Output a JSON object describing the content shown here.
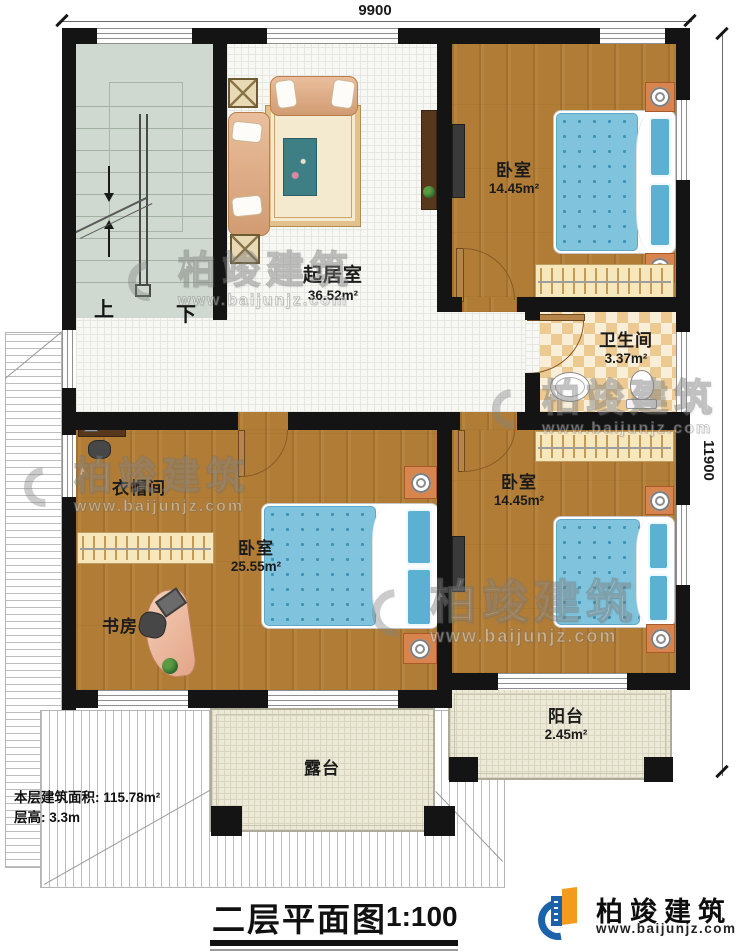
{
  "dimensions": {
    "width_label": "9900",
    "height_label": "11900"
  },
  "stairs": {
    "up_label": "上",
    "down_label": "下"
  },
  "rooms": {
    "living": {
      "name": "起居室",
      "area": "36.52m²"
    },
    "bedroom_top": {
      "name": "卧室",
      "area": "14.45m²"
    },
    "bathroom": {
      "name": "卫生间",
      "area": "3.37m²"
    },
    "cloakroom": {
      "name": "衣帽间"
    },
    "bedroom_master": {
      "name": "卧室",
      "area": "25.55m²"
    },
    "study": {
      "name": "书房"
    },
    "bedroom_right": {
      "name": "卧室",
      "area": "14.45m²"
    },
    "balcony": {
      "name": "阳台",
      "area": "2.45m²"
    },
    "terrace": {
      "name": "露台"
    }
  },
  "info": {
    "floor_area": "本层建筑面积: 115.78m²",
    "floor_height": "层高: 3.3m"
  },
  "title": {
    "name": "二层平面图",
    "scale": "1:100"
  },
  "brand": {
    "name": "柏竣建筑",
    "url": "www.baijunjz.com"
  },
  "watermark": {
    "name": "柏竣建筑",
    "url": "www.baijunjz.com"
  },
  "colors": {
    "wall": "#141414",
    "wood_floor": "#b17d36",
    "tile_floor": "#f7f7f4",
    "bathroom_tile": "#ecca92",
    "bed_blue": "#7fc3dc",
    "brand_blue": "#1b62ab",
    "brand_orange": "#f29b1d"
  }
}
